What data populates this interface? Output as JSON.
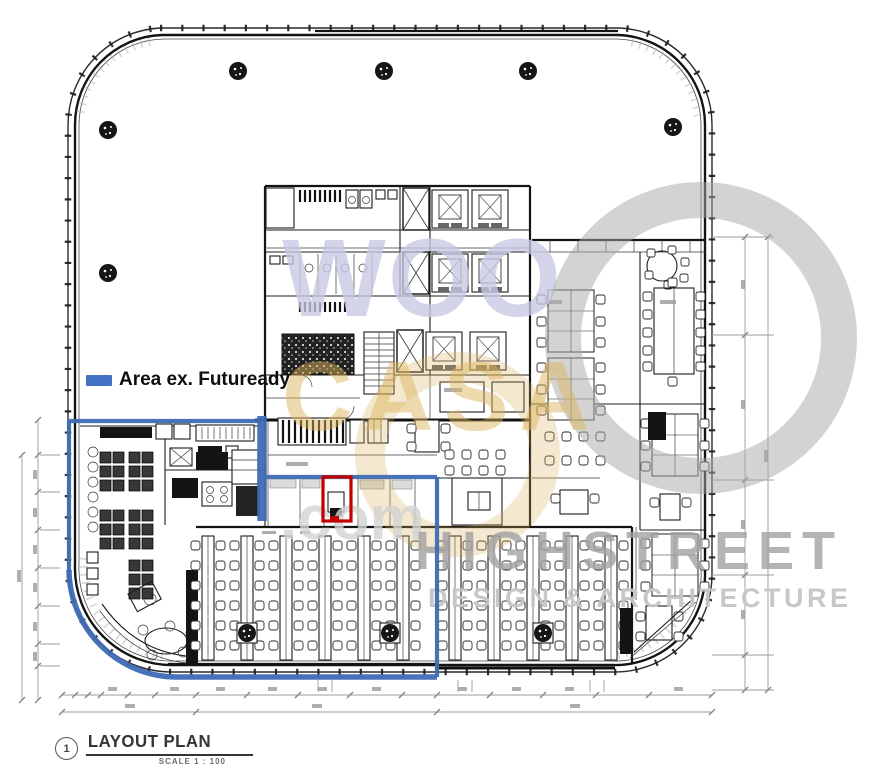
{
  "page": {
    "background_color": "#FFFFFF"
  },
  "legend": {
    "swatch_color": "#4472C4",
    "label": "Area ex. Futuready"
  },
  "annotations": {
    "area_outline_color": "#3F6CB5",
    "room_highlight_color": "#C00000"
  },
  "watermark": {
    "word_top": "WOO",
    "word_mid": "CASA",
    "word_domain": ".com",
    "word_firm": "HIGHSTREET",
    "word_tagline": "DESIGN & ARCHITECTURE",
    "color_word_top": "#C7C9E3",
    "color_word_mid": "#DDB45A",
    "color_word_domain": "#D4D4D4",
    "color_word_firm": "#A2A2A2",
    "color_word_tagline": "#C6C6C6",
    "color_circle": "#A8A8A8"
  },
  "title_block": {
    "detail_number": "1",
    "title": "LAYOUT PLAN",
    "scale": "SCALE 1 : 100"
  },
  "plan": {
    "drawing_type": "architectural floor plan"
  }
}
